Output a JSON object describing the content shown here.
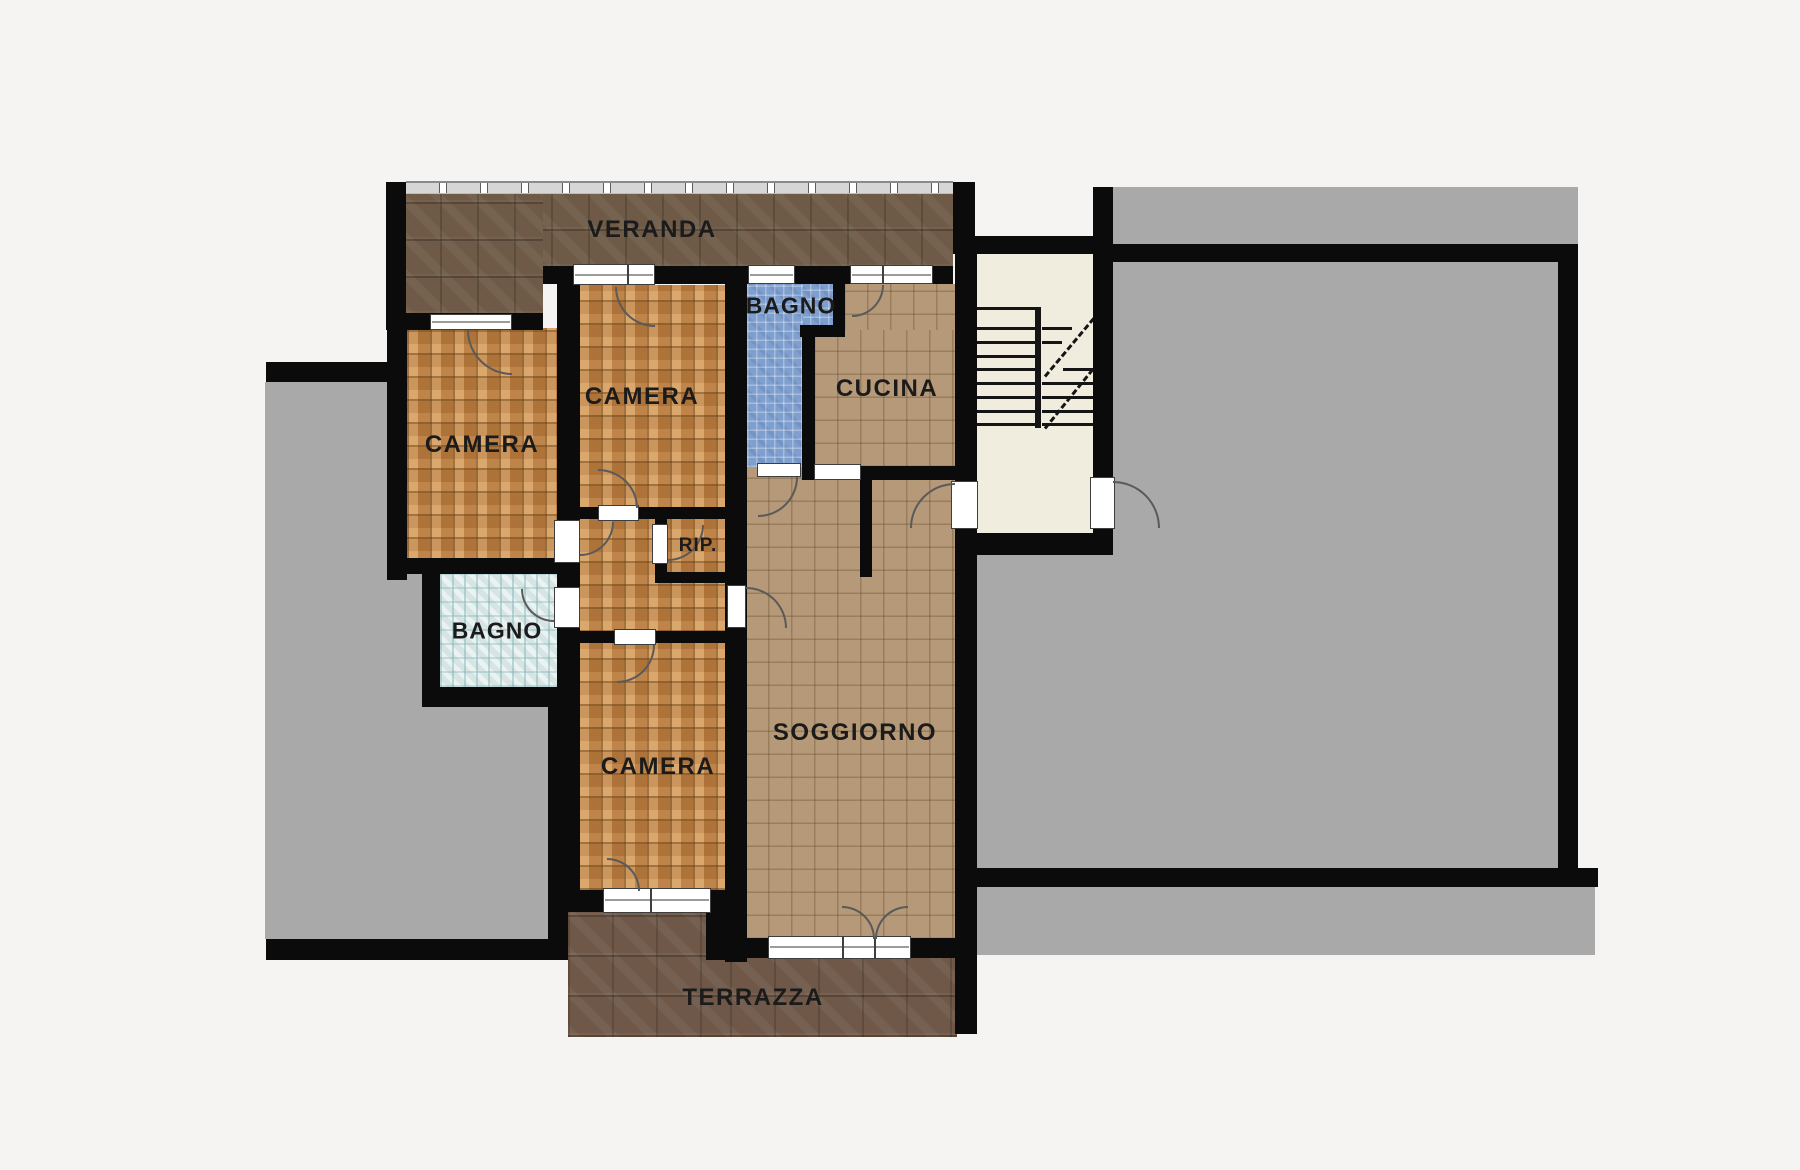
{
  "rooms": {
    "veranda": {
      "label": "VERANDA"
    },
    "camera_left": {
      "label": "CAMERA"
    },
    "camera_middle": {
      "label": "CAMERA"
    },
    "bagno_top": {
      "label": "BAGNO"
    },
    "cucina": {
      "label": "CUCINA"
    },
    "rip": {
      "label": "RIP."
    },
    "bagno_bottom": {
      "label": "BAGNO"
    },
    "camera_bottom": {
      "label": "CAMERA"
    },
    "soggiorno": {
      "label": "SOGGIORNO"
    },
    "terrazza": {
      "label": "TERRAZZA"
    }
  },
  "colors": {
    "background": "#f5f4f2",
    "wall": "#0b0b0b",
    "veranda_floor": "#6e5a46",
    "terrazza_floor": "#6f5848",
    "parquet": "#c5884c",
    "tan_tile": "#b59979",
    "blue_tile": "#7f9fce",
    "pale_bath_tile": "#d6e5e4",
    "neighbor_gray": "#a9a9a9",
    "stair_floor": "#f0edde",
    "label_text": "#1b1b1b"
  }
}
